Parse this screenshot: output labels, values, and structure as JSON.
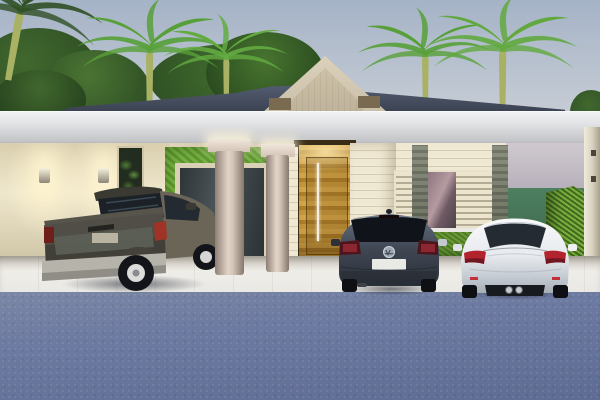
{
  "page": {
    "title": "3D exterior rendering of a house with carport at dusk"
  },
  "palette": {
    "sky-top": "#a5b3c7",
    "sky-mid": "#c2c9d3",
    "sky-low": "#d8d4d7",
    "foliage-dark": "#2f4f24",
    "foliage-mid": "#41682e",
    "palm-green": "#57a038",
    "palm-trunk": "#a9b264",
    "roof-slate": "#545d72",
    "roof-slate-dark": "#39404f",
    "gable-cream": "#dcd1ba",
    "gable-panel": "#cec2a8",
    "bracket-brown": "#7a6a50",
    "fascia-top": "#e4e5e7",
    "fascia-bottom": "#c4c5c8",
    "wall-cream": "#efe7cd",
    "wall-cream-dark": "#d9cfae",
    "sconce-glow": "#fff3cf",
    "living-wall-a": "#5f9a2f",
    "living-wall-b": "#79b345",
    "glass-dark": "#3a4147",
    "column-light": "#d3c4b6",
    "column-dark": "#8d7f74",
    "wood-a": "#d8a94a",
    "wood-b": "#b1822c",
    "wood-c": "#c89a3e",
    "slat-light": "#efe8d2",
    "slat-dark": "#d6ccb2",
    "stone-a": "#8b8f7e",
    "stone-b": "#646a59",
    "louver-a": "#ece4cc",
    "louver-b": "#b3ab94",
    "window-glass-a": "#8e7580",
    "window-glass-b": "#b59aa0",
    "sill-white": "#e9e7e2",
    "hedge-a": "#6a9a34",
    "hedge-b": "#7fae3f",
    "hedge-dark-a": "#4e7a28",
    "hedge-dark-b": "#3f6b1f",
    "wall-lavender-a": "#cfc9cf",
    "wall-lavender-b": "#b6afba",
    "accent-green": "#4e8060",
    "pillar-cream": "#d6cfbd",
    "floor-light": "#efede8",
    "floor-dark": "#d3cec4",
    "street-blue": "#6d7aa1",
    "street-blue-dark": "#5e6b92"
  },
  "scene": {
    "setting": "dusk",
    "style": "architectural 3D render",
    "elements": [
      "gradient dusk sky",
      "dark background shrubs",
      "four royal palm trees",
      "slate hip roof",
      "beige gable pediment with recessed panel",
      "two eave brackets",
      "white carport fascia band",
      "warm-lit cream side wall",
      "two wall sconces",
      "narrow plant niche",
      "green vertical-garden living wall",
      "framed glass door",
      "two round beige columns with capitals",
      "recessed wood entry wall",
      "pivot door with long pull handle",
      "cream horizontal-slat walls",
      "louvered shutter window with reflective glass",
      "two stone-clad pilasters",
      "window planter hedge",
      "lavender upper wall",
      "green accent wall",
      "tall clipped hedge",
      "cream boundary pillar with hinges",
      "white tiled carport floor",
      "blue-gray street pavement"
    ],
    "vehicles": [
      {
        "name": "pickup-truck",
        "body_color": "dark olive-gray",
        "bay": "left",
        "view": "rear three-quarter"
      },
      {
        "name": "vw-golf-hatchback",
        "body_color": "graphite gray",
        "bay": "center",
        "badge": "VW",
        "plate": "blank white"
      },
      {
        "name": "white-coupe",
        "body_color": "white",
        "bay": "right",
        "view": "rear"
      }
    ]
  }
}
